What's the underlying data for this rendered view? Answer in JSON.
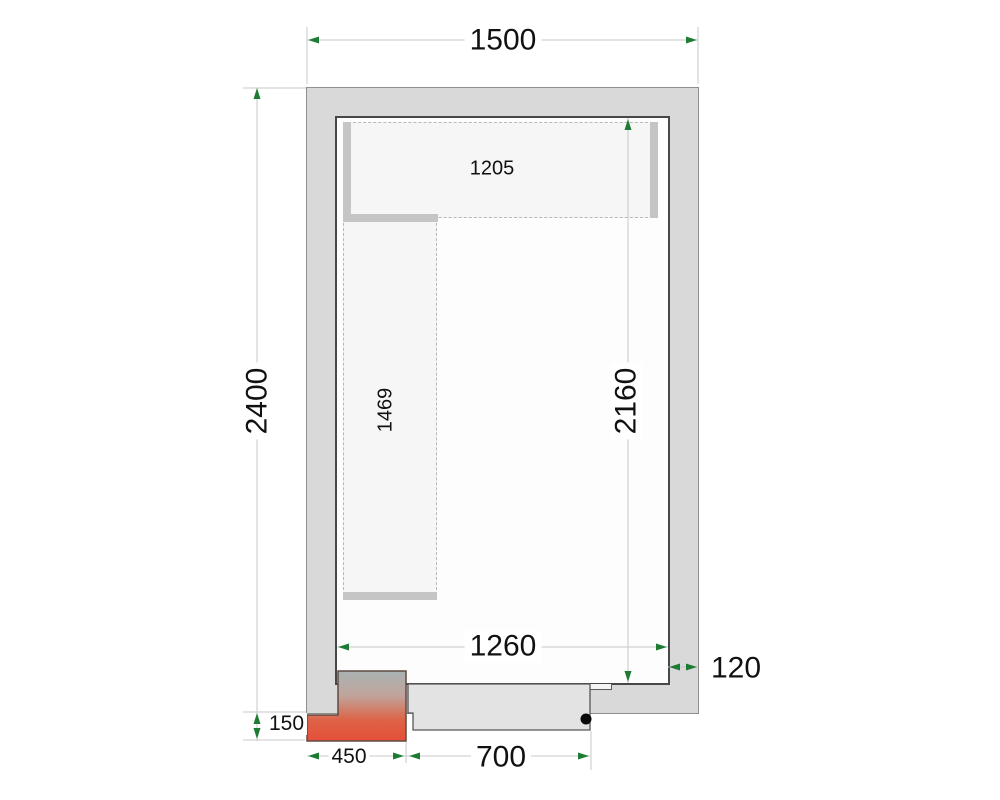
{
  "drawing": {
    "type": "cold-room floor plan",
    "labels": {
      "outer_width": "1500",
      "outer_depth": "2400",
      "inner_width": "1260",
      "inner_depth": "2160",
      "wall_thickness": "120",
      "door_width": "700",
      "unit_width": "450",
      "unit_protrusion": "150",
      "shelf_top_length": "1205",
      "shelf_left_length": "1469"
    },
    "colors": {
      "wall_fill": "#d9d9d9",
      "arrow_green": "#1e7b33",
      "dim_line": "#c8c8c8",
      "unit_hot": "#e54f38",
      "shelf_fill": "#f6f6f6"
    }
  }
}
